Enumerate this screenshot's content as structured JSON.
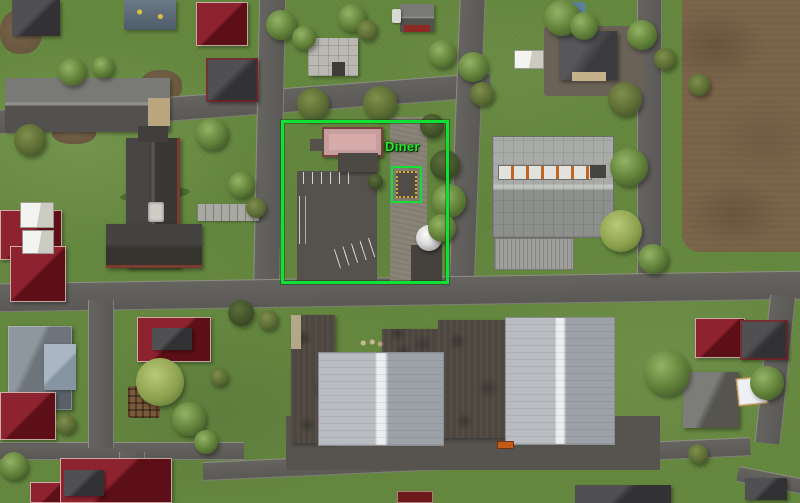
{
  "scene": {
    "description": "Top-down aerial view of a small town in a 3D simulation game",
    "view": "aerial top-down",
    "objects": [
      "diner building with pink roof",
      "diner parking lot with white line markings",
      "gravel path",
      "water tower",
      "placement marker square",
      "large warehouse with skylight strip",
      "ribbed storage shed",
      "church with front walkway",
      "red-roofed houses",
      "industrial hall complex with silver roofs",
      "plowed brown field",
      "residential blocks",
      "street trees"
    ]
  },
  "annotation": {
    "label": "Diner",
    "shape": "rectangle-highlight",
    "highlight_color": "#0ee234",
    "label_color": "#28e428",
    "marker": {
      "type": "placement-square",
      "border_color": "#0ee234",
      "dash_color": "#d9a92c"
    }
  },
  "palette": {
    "grass": "#65883f",
    "road": "#615f5a",
    "field": "#7b654a",
    "annotation-green": "#0ee234",
    "label-green": "#28e428",
    "marker-yellow": "#d9a92c",
    "red-roof": "#8e2330",
    "diner-roof": "#d7abaa"
  }
}
